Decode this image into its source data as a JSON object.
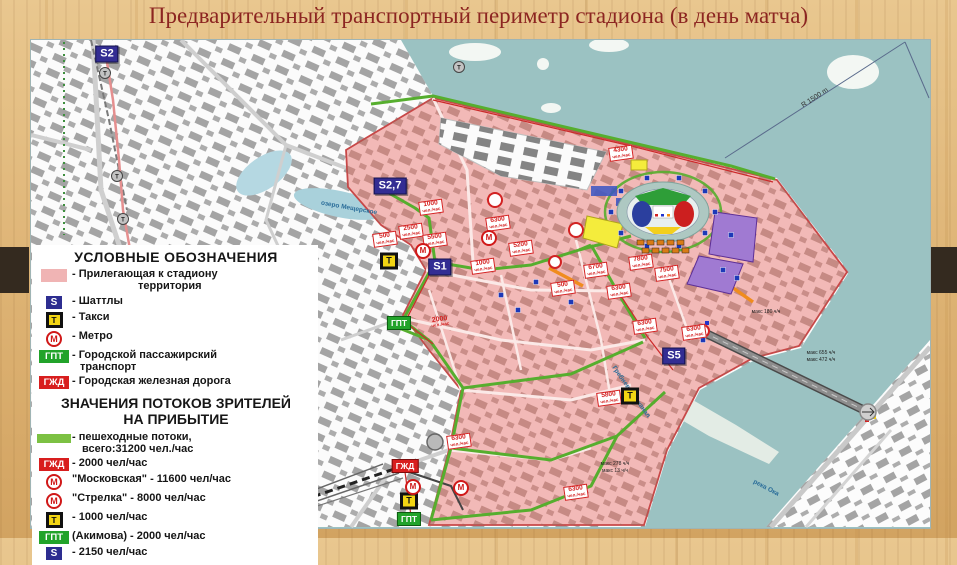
{
  "slide": {
    "title": "Предварительный транспортный периметр стадиона (в день матча)"
  },
  "colors": {
    "title_text": "#8c2521",
    "territory_pink": "#f0b4b4",
    "pedestrian_flow_green": "#7cc143",
    "water_teal": "#9bc2c2",
    "shuttle_blue": "#2d2d90",
    "taxi_yellow": "#f2d513",
    "metro_red": "#d01818",
    "gpt_green": "#22a32a",
    "gzd_red": "#d81e1e"
  },
  "legend": {
    "title": "УСЛОВНЫЕ ОБОЗНАЧЕНИЯ",
    "items": [
      {
        "badge": {
          "type": "area",
          "text": ""
        },
        "label": "- Прилегающая к стадиону",
        "label2": "территория",
        "indent2": 66
      },
      {
        "badge": {
          "type": "shuttle",
          "text": "S"
        },
        "label": "- Шаттлы"
      },
      {
        "badge": {
          "type": "taxi",
          "text": "Т"
        },
        "label": "- Такси"
      },
      {
        "badge": {
          "type": "metro",
          "text": "М"
        },
        "label": "- Метро"
      },
      {
        "badge": {
          "type": "gpt",
          "text": "ГПТ"
        },
        "label": "- Городской пассажирский",
        "label2": "транспорт",
        "indent2": 8
      },
      {
        "badge": {
          "type": "gzd",
          "text": "ГЖД"
        },
        "label": "- Городская железная дорога"
      }
    ]
  },
  "flows": {
    "title_line1": "ЗНАЧЕНИЯ ПОТОКОВ ЗРИТЕЛЕЙ",
    "title_line2": "НА ПРИБЫТИЕ",
    "items": [
      {
        "badge": {
          "type": "flow",
          "text": ""
        },
        "label": "- пешеходные потоки,",
        "label2": "всего:31200 чел./час",
        "indent2": 10
      },
      {
        "badge": {
          "type": "gzd",
          "text": "ГЖД"
        },
        "label": "- 2000 чел/час"
      },
      {
        "badge": {
          "type": "metro",
          "text": "М"
        },
        "label": "\"Московская\" - 11600 чел/час"
      },
      {
        "badge": {
          "type": "metro",
          "text": "М"
        },
        "label": "\"Стрелка\" - 8000 чел/час"
      },
      {
        "badge": {
          "type": "taxi",
          "text": "Т"
        },
        "label": "- 1000 чел/час"
      },
      {
        "badge": {
          "type": "gpt",
          "text": "ГПТ"
        },
        "label": "(Акимова) - 2000 чел/час"
      },
      {
        "badge": {
          "type": "shuttle",
          "text": "S"
        },
        "label": "- 2150 чел/час"
      }
    ]
  },
  "map": {
    "flow_unit": "чел./час",
    "markers": [
      {
        "id": "s2",
        "type": "shuttle",
        "text": "S2",
        "x": 76,
        "y": 14
      },
      {
        "id": "s2-7",
        "type": "shuttle",
        "text": "S2,7",
        "x": 359,
        "y": 146
      },
      {
        "id": "s1",
        "type": "shuttle",
        "text": "S1",
        "x": 409,
        "y": 227
      },
      {
        "id": "s5",
        "type": "shuttle",
        "text": "S5",
        "x": 643,
        "y": 316
      },
      {
        "id": "taxi-1",
        "type": "taxi",
        "text": "Т",
        "x": 358,
        "y": 221
      },
      {
        "id": "taxi-2",
        "type": "taxi",
        "text": "Т",
        "x": 599,
        "y": 356
      },
      {
        "id": "taxi-3",
        "type": "taxi",
        "text": "Т",
        "x": 378,
        "y": 461
      },
      {
        "id": "metro-1",
        "type": "metro",
        "text": "М",
        "x": 392,
        "y": 211
      },
      {
        "id": "metro-2",
        "type": "metro",
        "text": "М",
        "x": 458,
        "y": 198
      },
      {
        "id": "metro-3",
        "type": "metro",
        "text": "М",
        "x": 382,
        "y": 447
      },
      {
        "id": "metro-4",
        "type": "metro",
        "text": "М",
        "x": 430,
        "y": 448
      },
      {
        "id": "gpt-1",
        "type": "gpt",
        "text": "ГПТ",
        "x": 368,
        "y": 283
      },
      {
        "id": "gpt-2",
        "type": "gpt",
        "text": "ГПТ",
        "x": 378,
        "y": 479
      },
      {
        "id": "gzd-1",
        "type": "gzd",
        "text": "ГЖД",
        "x": 374,
        "y": 426
      }
    ],
    "flow_labels": [
      {
        "v": "1000",
        "x": 400,
        "y": 167
      },
      {
        "v": "2500",
        "x": 380,
        "y": 191
      },
      {
        "v": "500",
        "x": 354,
        "y": 199
      },
      {
        "v": "5500",
        "x": 404,
        "y": 200
      },
      {
        "v": "6300",
        "x": 467,
        "y": 183
      },
      {
        "v": "5200",
        "x": 490,
        "y": 208
      },
      {
        "v": "1000",
        "x": 452,
        "y": 226
      },
      {
        "v": "4300",
        "x": 590,
        "y": 113
      },
      {
        "v": "6700",
        "x": 565,
        "y": 230
      },
      {
        "v": "500",
        "x": 532,
        "y": 248
      },
      {
        "v": "7800",
        "x": 610,
        "y": 222
      },
      {
        "v": "7500",
        "x": 636,
        "y": 233
      },
      {
        "v": "6300",
        "x": 588,
        "y": 251
      },
      {
        "v": "6300",
        "x": 614,
        "y": 286
      },
      {
        "v": "6300",
        "x": 663,
        "y": 292
      },
      {
        "v": "6300",
        "x": 428,
        "y": 401
      },
      {
        "v": "5800",
        "x": 578,
        "y": 358
      },
      {
        "v": "6300",
        "x": 545,
        "y": 452
      },
      {
        "v": "2000",
        "x": 409,
        "y": 282,
        "plain": true
      }
    ],
    "annotations": [
      {
        "text": "R 1500 m",
        "x": 784,
        "y": 58,
        "rot": -33,
        "cls": "radius"
      },
      {
        "text": "озеро Мещерское",
        "x": 318,
        "y": 168,
        "rot": 10,
        "cls": "water-label"
      },
      {
        "text": "Гребневский канал",
        "x": 600,
        "y": 352,
        "rot": 55,
        "cls": "water-label"
      },
      {
        "text": "река Ока",
        "x": 735,
        "y": 448,
        "rot": 28,
        "cls": "water-label"
      },
      {
        "text": "макс 180 ч/ч",
        "x": 735,
        "y": 272,
        "rot": 0,
        "cls": "tiny"
      },
      {
        "text": "макс 655 ч/ч",
        "x": 790,
        "y": 313,
        "rot": 0,
        "cls": "tiny"
      },
      {
        "text": "макс 472 ч/ч",
        "x": 790,
        "y": 320,
        "rot": 0,
        "cls": "tiny"
      },
      {
        "text": "макс 278 ч/ч",
        "x": 584,
        "y": 424,
        "rot": 0,
        "cls": "tiny"
      },
      {
        "text": "макс 13 ч/ч",
        "x": 584,
        "y": 431,
        "rot": 0,
        "cls": "tiny"
      }
    ]
  }
}
